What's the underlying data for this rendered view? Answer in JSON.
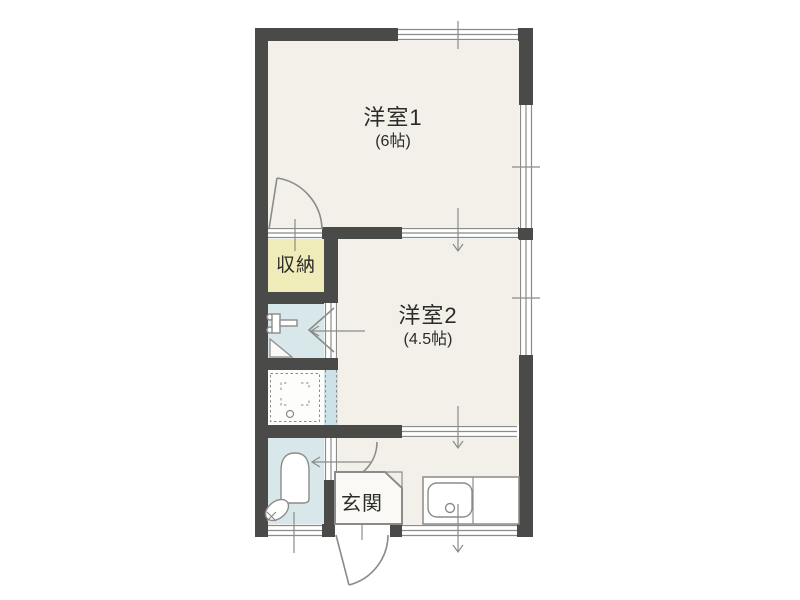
{
  "floorplan": {
    "rooms": [
      {
        "label": "洋室1",
        "size": "(6帖)"
      },
      {
        "label": "洋室2",
        "size": "(4.5帖)"
      },
      {
        "label": "収納"
      },
      {
        "label": "玄関"
      }
    ],
    "colors": {
      "wall": "#4a4a48",
      "floor": "#f2f0e9",
      "storage": "#f0ecba",
      "water": "#d7e7ea",
      "bathdoor": "#cde2e6",
      "line": "#8b8b89",
      "text": "#2b2b29"
    }
  }
}
